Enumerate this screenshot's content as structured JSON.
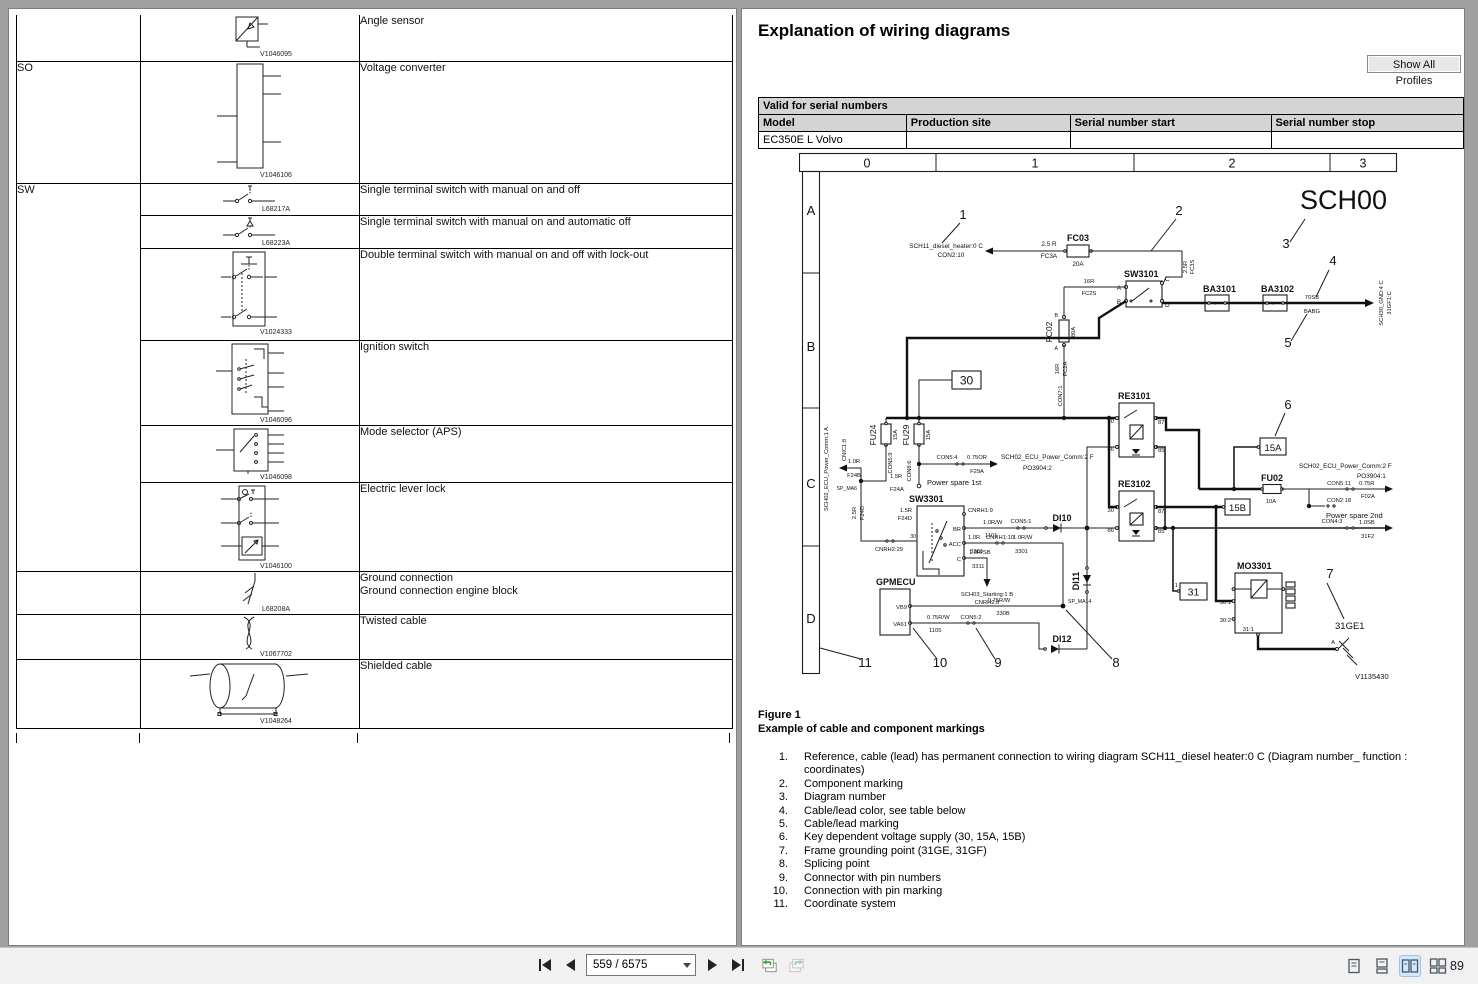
{
  "colors": {
    "page_bg": "#ffffff",
    "frame": "#a0a0a0",
    "toolbar_bg": "#f1f1f1",
    "active_layout_bg": "#cfe8ff",
    "view_arrow_green": "#3f9c3f"
  },
  "toolbar": {
    "page": "559 / 6575",
    "zoom": "89"
  },
  "left_table": {
    "codes": {
      "so": "SO",
      "sw": "SW"
    },
    "rows": [
      {
        "desc": "Angle sensor",
        "ref": "V1046095"
      },
      {
        "desc": "Voltage converter",
        "ref": "V1046106"
      },
      {
        "desc": "Single terminal switch with manual on and off",
        "ref": "L68217A"
      },
      {
        "desc": "Single terminal switch with manual on and automatic off",
        "ref": "L68223A"
      },
      {
        "desc": "Double terminal switch with manual on and off with lock-out",
        "ref": "V1024333"
      },
      {
        "desc": "Ignition switch",
        "ref": "V1046096"
      },
      {
        "desc": "Mode selector (APS)",
        "ref": "V1046098"
      },
      {
        "desc": "Electric lever lock",
        "ref": "V1046100"
      },
      {
        "desc": "Ground connection",
        "desc2": "Ground connection engine block",
        "ref": "L68208A"
      },
      {
        "desc": "Twisted cable",
        "ref": "V1067702"
      },
      {
        "desc": "Shielded cable",
        "ref": "V1048264"
      }
    ]
  },
  "right_page": {
    "title": "Explanation of wiring diagrams",
    "show_all_profiles": "Show All Profiles",
    "serial_table": {
      "caption": "Valid for serial numbers",
      "columns": [
        "Model",
        "Production site",
        "Serial number start",
        "Serial number stop"
      ],
      "row": [
        "EC350E L Volvo",
        "",
        "",
        ""
      ]
    },
    "figure": {
      "label": "Figure 1",
      "caption": "Example of cable and component markings"
    },
    "legend": [
      {
        "n": "1.",
        "t": "Reference, cable (lead) has permanent connection to wiring diagram SCH11_diesel heater:0 C (Diagram number_ function : coordinates)"
      },
      {
        "n": "2.",
        "t": "Component marking"
      },
      {
        "n": "3.",
        "t": "Diagram number"
      },
      {
        "n": "4.",
        "t": "Cable/lead color, see table below"
      },
      {
        "n": "5.",
        "t": "Cable/lead marking"
      },
      {
        "n": "6.",
        "t": "Key dependent voltage supply (30, 15A, 15B)"
      },
      {
        "n": "7.",
        "t": "Frame grounding point (31GE, 31GF)"
      },
      {
        "n": "8.",
        "t": "Splicing point"
      },
      {
        "n": "9.",
        "t": "Connector with pin numbers"
      },
      {
        "n": "10.",
        "t": "Connection with pin marking"
      },
      {
        "n": "11.",
        "t": "Coordinate system"
      }
    ]
  },
  "dg": {
    "cols": [
      "0",
      "1",
      "2",
      "3"
    ],
    "rows": [
      "A",
      "B",
      "C",
      "D"
    ],
    "c": [
      "1",
      "2",
      "3",
      "4",
      "5",
      "6",
      "7",
      "8",
      "9",
      "10",
      "11"
    ],
    "sch00": "SCH00",
    "ref1a": "SCH11_diesel_heater:0 C",
    "ref1b": "CON2:10",
    "w25r": "2.5 R",
    "fc3a": "FC3A",
    "fc03": "FC03",
    "a20": "20A",
    "fc3s1": "2.5R",
    "fc3s2": "FC3S",
    "sw3101": "SW3101",
    "pA": "A",
    "pB": "B",
    "pC": "C",
    "pD": "D",
    "ba3101": "BA3101",
    "ba3102": "BA3102",
    "pm": "+  -",
    "w70sb": "70SB",
    "babg": "BABG",
    "gndref1": "SCH30_GND:4 C",
    "gndref2": "31GF1:C",
    "r16a": "16R",
    "fc2s": "FC2S",
    "fc02": "FC02",
    "a80": "80A",
    "r16b": "16R",
    "fc2a": "FC2A",
    "con71": "CON7:1",
    "b30": "30",
    "fu24": "FU24",
    "a15": "15A",
    "con59": "CON5:9",
    "fu29": "FU29",
    "con86": "CON8:6",
    "con54": "CON5:4",
    "or075": "0.75OR",
    "f29a": "F29A",
    "ecu2f": "SCH02_ECU_Power_Comm:2 F",
    "po2": "PO3904:2",
    "pwr1": "Power spare 1st",
    "r10": "1.0R",
    "f24b": "F24B",
    "cnic": "CNIC1:8",
    "spma6": "SP_MA6",
    "ecu1a": "SCH02_ECU_Power_Comm:1 A",
    "r15": "1.5R",
    "f24a": "F24A",
    "r25": "2.5R",
    "f24d": "F24D",
    "cnrh229": "CNRH2:29",
    "p30": "30",
    "sw3301": "SW3301",
    "cnrh19": "CNRH1:9",
    "pBR": "BR",
    "rw10": "1.0R/W",
    "n1101": "1101",
    "con51": "CON5:1",
    "di10": "DI10",
    "pACC": "ACC",
    "accr10": "1.0R",
    "n3301": "3301",
    "cnrh110": "CNRH1:10",
    "pCc": "C",
    "rsb10": "1.0R/SB",
    "n3311": "3311",
    "sch03a": "SCH03_Starting:1 B",
    "cnrh28": "CNRH2:8",
    "gpmecu": "GPMECU",
    "vb9": "VB9",
    "va61": "VA61",
    "rw075": "0.75R/W",
    "n330b": "330B",
    "n1105": "1105",
    "con52": "CON5:2",
    "di12": "DI12",
    "di11": "DI11",
    "spma14": "SP_MA14",
    "re3101": "RE3101",
    "re3102": "RE3102",
    "p87": "87",
    "p86": "86",
    "p85": "85",
    "b15a": "15A",
    "b15b": "15B",
    "fu02": "FU02",
    "a10": "10A",
    "po1": "PO3904:1",
    "con511": "CON5:11",
    "r075": "0.75R",
    "f02a": "F02A",
    "con218": "CON2:18",
    "pwr2": "Power spare 2nd",
    "con43": "CON4:3",
    "sb10": "1.0SB",
    "n31f2": "31F2",
    "b31": "31",
    "n1": "1",
    "mo3301": "MO3301",
    "m301": "30:1",
    "m302": "30:2",
    "m311": "31:1",
    "g31ge1": "31GE1",
    "vref": "V1135430"
  }
}
